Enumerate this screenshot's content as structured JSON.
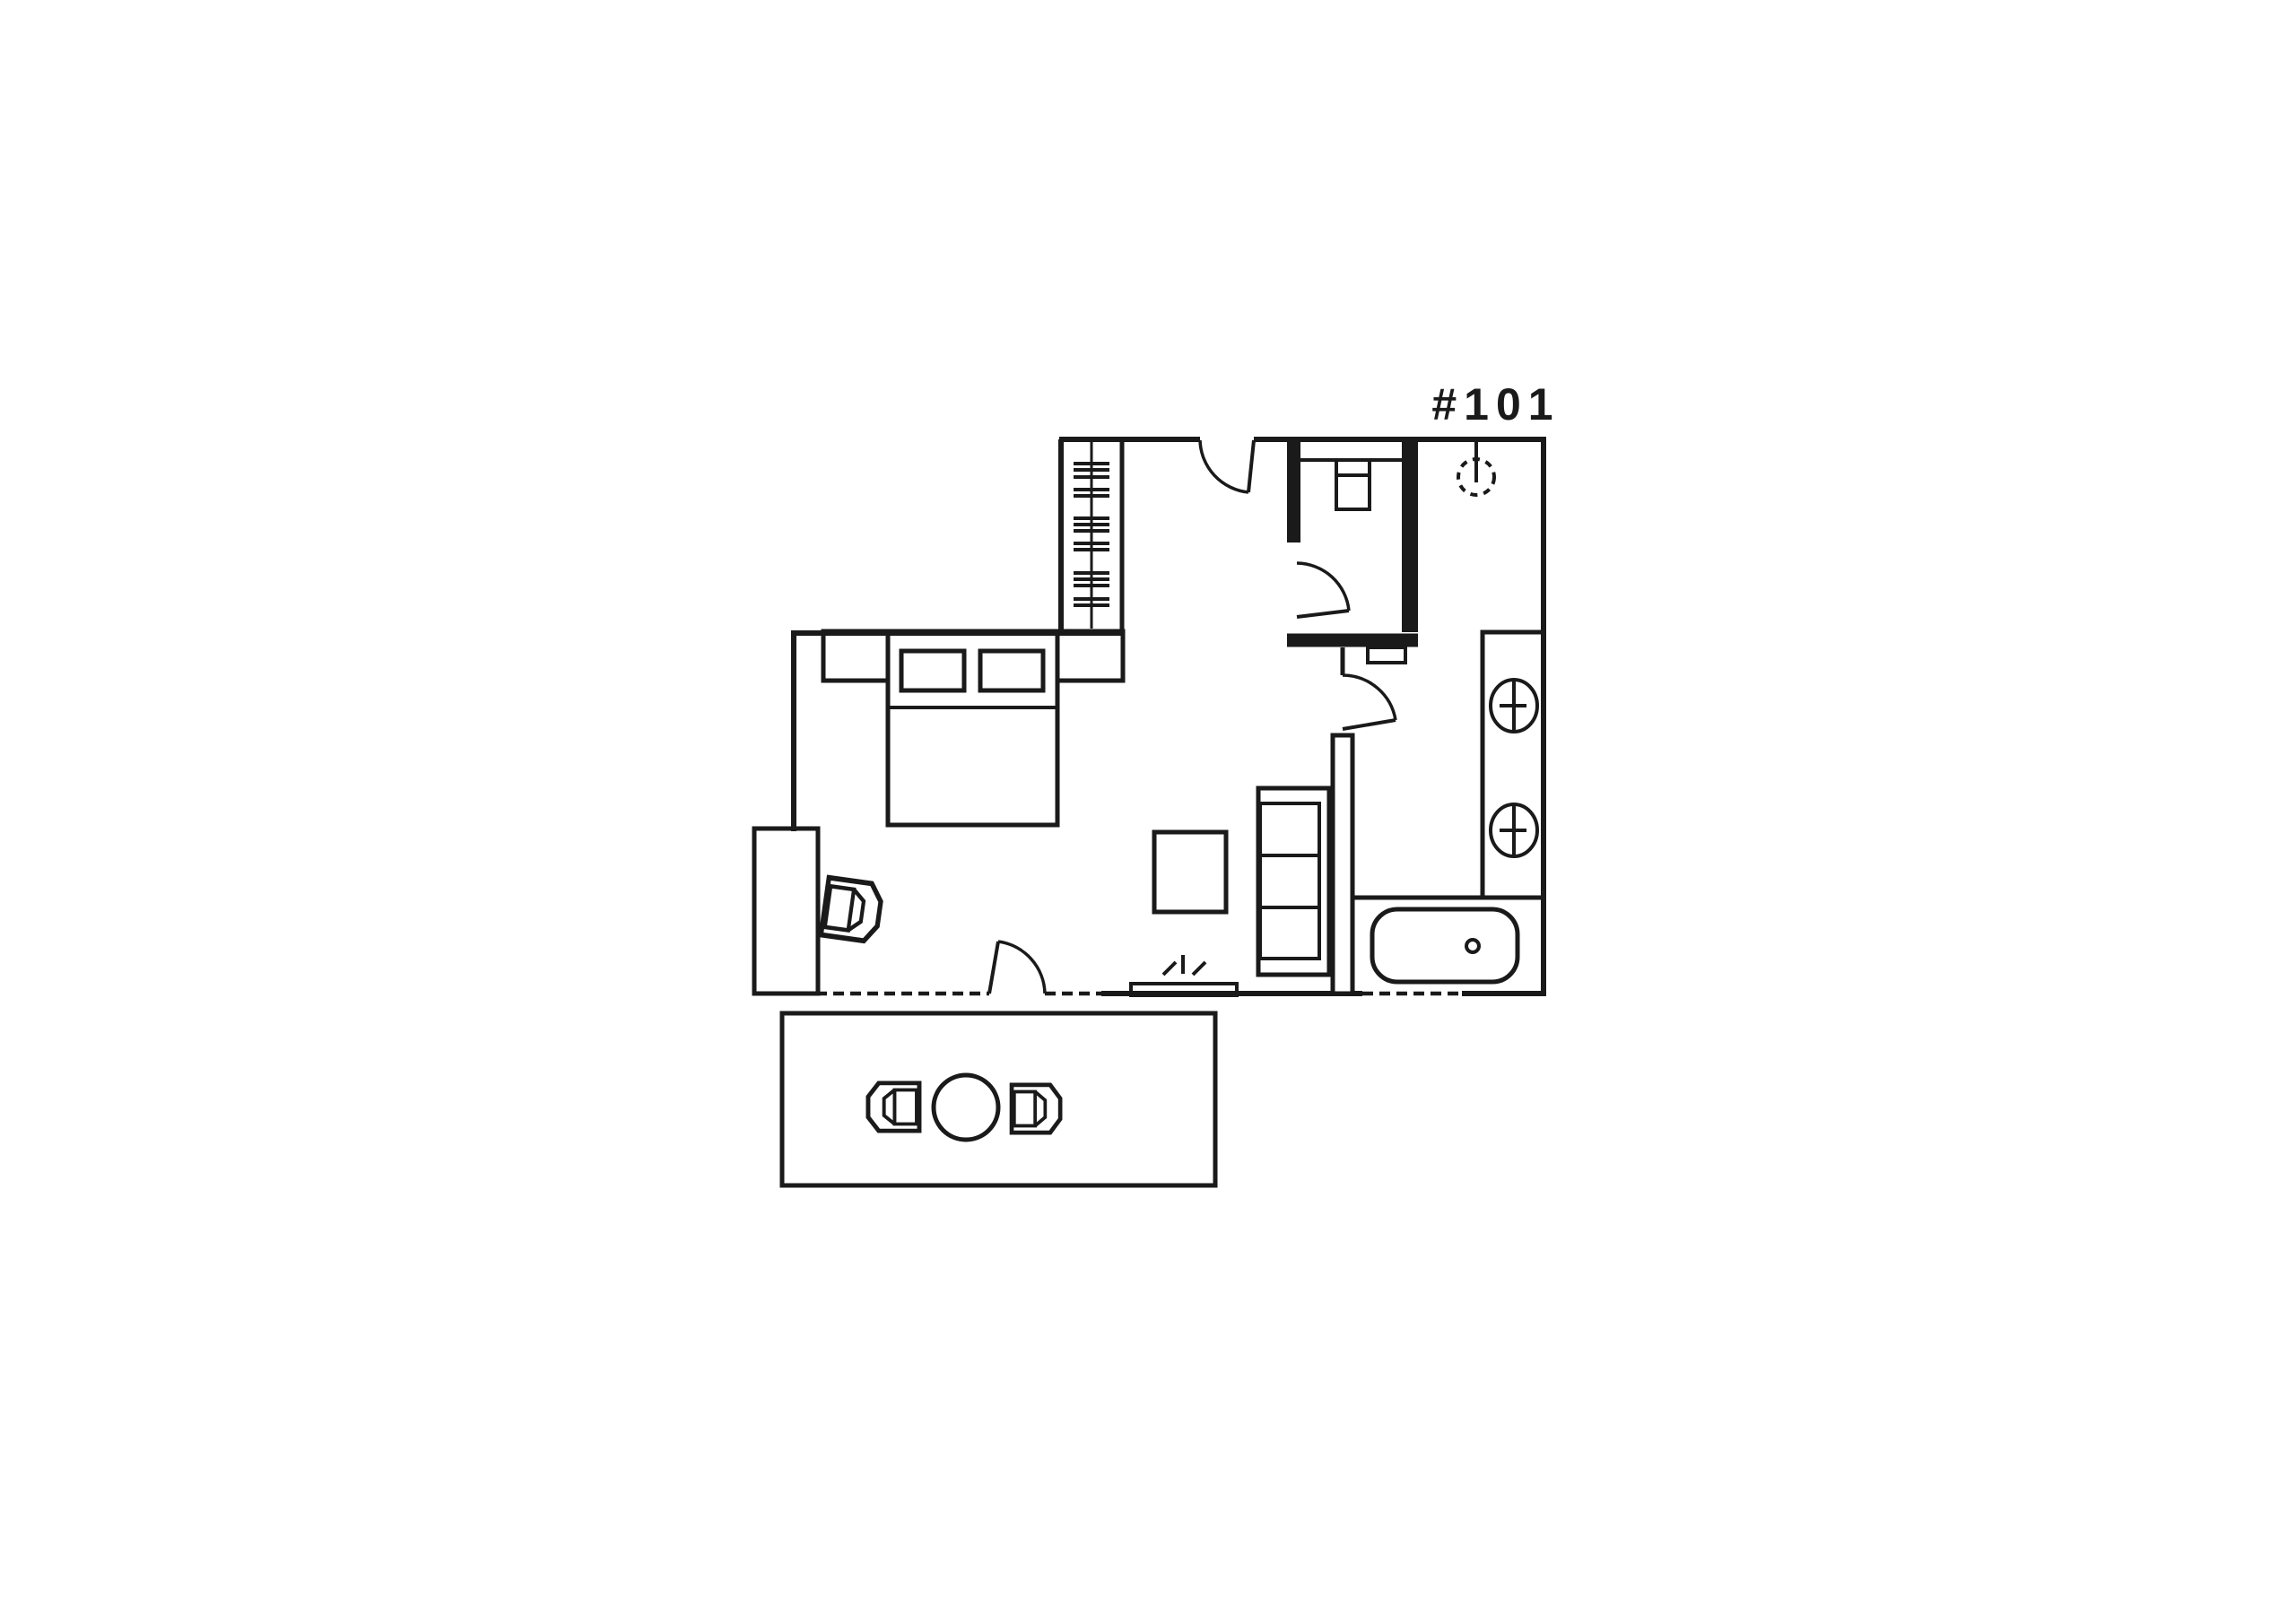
{
  "title": {
    "unit_label": "#101"
  },
  "colors": {
    "ink": "#1a1a1a",
    "background": "#ffffff"
  },
  "fixtures": [
    "entry-door",
    "wardrobe-hanger-rail",
    "wc-toilet",
    "wc-door",
    "pendant-light",
    "bathroom-door",
    "double-sink-vanity",
    "bathtub",
    "sofa",
    "coffee-table",
    "tv",
    "terrace-door",
    "double-bed",
    "pillows",
    "nightstand-left",
    "nightstand-right",
    "desk",
    "desk-chair",
    "deck",
    "deck-table",
    "deck-chair-left",
    "deck-chair-right"
  ]
}
